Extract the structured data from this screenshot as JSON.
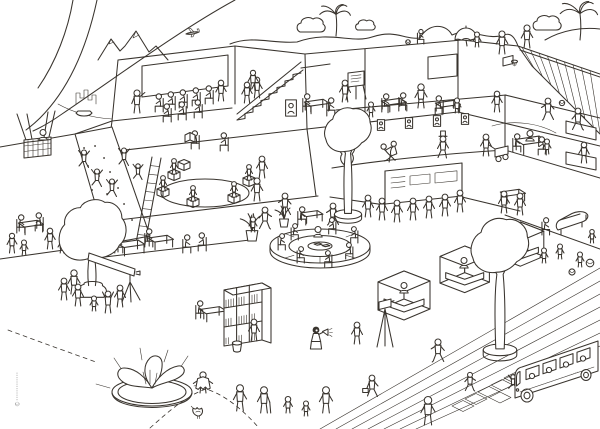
{
  "meta": {
    "copyright": "©",
    "artwork": "busy-learning-building-cutaway-illustration"
  },
  "palette": {
    "ink": "#39342e",
    "paper": "#ffffff"
  },
  "scene": {
    "items": [
      {
        "t": "mountains",
        "x": 98,
        "y": 60,
        "n": "mountains"
      },
      {
        "t": "plane",
        "x": 186,
        "y": 36,
        "n": "airplane"
      },
      {
        "t": "skyline",
        "x": 76,
        "y": 104,
        "n": "city-skyline"
      },
      {
        "t": "boat",
        "x": 84,
        "y": 115,
        "n": "rowing-boat"
      },
      {
        "t": "palm",
        "x": 336,
        "y": 36,
        "s": 0.9,
        "n": "hill-plant"
      },
      {
        "t": "bush",
        "x": 312,
        "y": 32,
        "n": "hill-bush"
      },
      {
        "t": "bush",
        "x": 366,
        "y": 30,
        "s": 0.7,
        "n": "hill-bush"
      },
      {
        "t": "psit",
        "x": 420,
        "y": 44,
        "s": 0.8,
        "n": "hill-sitter"
      },
      {
        "t": "ball",
        "x": 408,
        "y": 42,
        "s": 0.6,
        "n": "picnic-wheel"
      },
      {
        "t": "umbrella",
        "x": 466,
        "y": 40,
        "n": "roof-umbrella"
      },
      {
        "t": "pkid",
        "x": 477,
        "y": 47,
        "n": "kid-under-umbrella"
      },
      {
        "t": "pstand",
        "x": 502,
        "y": 54,
        "s": 1.05,
        "n": "ridge-walker"
      },
      {
        "t": "bush",
        "x": 548,
        "y": 30,
        "n": "hill-bush"
      },
      {
        "t": "palm",
        "x": 580,
        "y": 40,
        "s": 1.1,
        "n": "rooftop-palm"
      },
      {
        "t": "pstand",
        "x": 527,
        "y": 48,
        "s": 1.05,
        "n": "roof-person"
      },
      {
        "t": "balloonbasket",
        "x": 24,
        "y": 158,
        "n": "balloon-basket"
      },
      {
        "t": "pbust",
        "x": 43,
        "y": 140,
        "n": "balloon-passenger"
      },
      {
        "t": "ppoint",
        "x": 137,
        "y": 113,
        "s": 1.05,
        "n": "lecturer"
      },
      {
        "t": "psit",
        "x": 160,
        "y": 112,
        "f": 1,
        "n": "audience"
      },
      {
        "t": "psit",
        "x": 172,
        "y": 110,
        "f": 1,
        "n": "audience"
      },
      {
        "t": "psit",
        "x": 184,
        "y": 108,
        "f": 1,
        "n": "audience"
      },
      {
        "t": "psit",
        "x": 197,
        "y": 106,
        "f": 1,
        "n": "audience"
      },
      {
        "t": "psit",
        "x": 210,
        "y": 104,
        "f": 1,
        "n": "audience"
      },
      {
        "t": "psit",
        "x": 168,
        "y": 122,
        "f": 1,
        "n": "audience"
      },
      {
        "t": "psit",
        "x": 183,
        "y": 120,
        "f": 1,
        "n": "audience"
      },
      {
        "t": "psit",
        "x": 199,
        "y": 118,
        "f": 1,
        "n": "audience"
      },
      {
        "t": "pstand",
        "x": 221,
        "y": 101,
        "s": 0.95,
        "n": "standing-listener"
      },
      {
        "t": "pstand",
        "x": 247,
        "y": 103,
        "s": 0.95,
        "n": "stairs-person"
      },
      {
        "t": "pstand",
        "x": 257,
        "y": 98,
        "s": 0.95,
        "n": "stairs-person"
      },
      {
        "t": "pstand",
        "x": 253,
        "y": 90,
        "s": 0.9,
        "n": "stairs-person"
      },
      {
        "t": "frame",
        "x": 291,
        "y": 108,
        "s": 1.5,
        "n": "framed-picture"
      },
      {
        "t": "psit",
        "x": 196,
        "y": 149,
        "f": 1,
        "n": "armchair-reader"
      },
      {
        "t": "openbook",
        "x": 190,
        "y": 142,
        "n": "open-book"
      },
      {
        "t": "psit",
        "x": 225,
        "y": 151,
        "f": 1,
        "n": "lounger"
      },
      {
        "t": "pstand",
        "x": 262,
        "y": 178,
        "f": 1,
        "n": "phone-person"
      },
      {
        "t": "pclimb",
        "x": 84,
        "y": 168,
        "n": "climber"
      },
      {
        "t": "pclimb",
        "x": 97,
        "y": 187,
        "n": "climber"
      },
      {
        "t": "pclimb",
        "x": 112,
        "y": 197,
        "n": "climber-afro"
      },
      {
        "t": "pclimb",
        "x": 124,
        "y": 166,
        "n": "climber"
      },
      {
        "t": "ladder",
        "x": 136,
        "y": 243,
        "n": "ladder"
      },
      {
        "t": "pclimb",
        "x": 138,
        "y": 180,
        "s": 0.9,
        "n": "ladder-climber"
      },
      {
        "t": "cube",
        "x": 178,
        "y": 171,
        "n": "stool-cube"
      },
      {
        "t": "pcube",
        "x": 168,
        "y": 181,
        "n": "story-circle-kid"
      },
      {
        "t": "pcube",
        "x": 157,
        "y": 198,
        "n": "story-circle-kid"
      },
      {
        "t": "pcube",
        "x": 187,
        "y": 208,
        "n": "story-circle-kid"
      },
      {
        "t": "pcube",
        "x": 228,
        "y": 204,
        "n": "story-circle-kid"
      },
      {
        "t": "pcube",
        "x": 243,
        "y": 187,
        "n": "story-circle-kid"
      },
      {
        "t": "pstand",
        "x": 257,
        "y": 201,
        "s": 1.05,
        "n": "storyteller"
      },
      {
        "t": "easel",
        "x": 356,
        "y": 100,
        "n": "flip-chart"
      },
      {
        "t": "pstand",
        "x": 345,
        "y": 102,
        "f": 1,
        "n": "presenting-artist"
      },
      {
        "t": "desk",
        "x": 316,
        "y": 111,
        "s": 0.9,
        "n": "work-table"
      },
      {
        "t": "psit",
        "x": 306,
        "y": 112,
        "n": "pupil"
      },
      {
        "t": "psit",
        "x": 330,
        "y": 116,
        "n": "pupil"
      },
      {
        "t": "pkid",
        "x": 371,
        "y": 117,
        "n": "pupil-kid"
      },
      {
        "t": "pstand",
        "x": 421,
        "y": 108,
        "s": 1.1,
        "n": "teacher"
      },
      {
        "t": "desk",
        "x": 393,
        "y": 110,
        "s": 0.9,
        "n": "school-desk"
      },
      {
        "t": "psit",
        "x": 385,
        "y": 112,
        "n": "student"
      },
      {
        "t": "psit",
        "x": 402,
        "y": 111,
        "n": "student"
      },
      {
        "t": "desk",
        "x": 447,
        "y": 112,
        "s": 0.9,
        "n": "school-desk"
      },
      {
        "t": "psit",
        "x": 440,
        "y": 114,
        "f": 1,
        "n": "student"
      },
      {
        "t": "pkid",
        "x": 457,
        "y": 113,
        "n": "student-kid"
      },
      {
        "t": "hoop",
        "x": 503,
        "y": 66,
        "n": "basketball-hoop"
      },
      {
        "t": "pstand",
        "x": 497,
        "y": 112,
        "s": 0.95,
        "n": "basketball-player"
      },
      {
        "t": "pwalk",
        "x": 548,
        "y": 120,
        "f": 1,
        "n": "basketball-player"
      },
      {
        "t": "pwalk",
        "x": 578,
        "y": 130,
        "n": "basketball-player"
      },
      {
        "t": "ball",
        "x": 562,
        "y": 103,
        "s": 0.7,
        "n": "basketball"
      },
      {
        "t": "cypress",
        "x": 347,
        "y": 168,
        "n": "indoor-cypress"
      },
      {
        "t": "frame",
        "x": 363,
        "y": 127,
        "n": "portrait-frame"
      },
      {
        "t": "frame",
        "x": 381,
        "y": 125,
        "n": "portrait-frame"
      },
      {
        "t": "frame",
        "x": 409,
        "y": 123,
        "n": "portrait-frame"
      },
      {
        "t": "frame",
        "x": 437,
        "y": 121,
        "n": "portrait-frame"
      },
      {
        "t": "frame",
        "x": 465,
        "y": 119,
        "n": "portrait-frame"
      },
      {
        "t": "tango",
        "x": 388,
        "y": 162,
        "s": 1.1,
        "n": "tango-dancers"
      },
      {
        "t": "ptophat",
        "x": 443,
        "y": 158,
        "n": "top-hat-man"
      },
      {
        "t": "pstand",
        "x": 486,
        "y": 156,
        "f": 1,
        "n": "cart-puller"
      },
      {
        "t": "cart",
        "x": 495,
        "y": 158,
        "n": "cart"
      },
      {
        "t": "desk",
        "x": 530,
        "y": 151,
        "s": 1.15,
        "n": "dining-table"
      },
      {
        "t": "psit",
        "x": 516,
        "y": 152,
        "n": "diner"
      },
      {
        "t": "psit",
        "x": 543,
        "y": 155,
        "f": 1,
        "n": "diner"
      },
      {
        "t": "pbust",
        "x": 530,
        "y": 141,
        "n": "diner"
      },
      {
        "t": "pkid",
        "x": 547,
        "y": 154,
        "n": "diner-kid"
      },
      {
        "t": "pstand",
        "x": 584,
        "y": 163,
        "f": 1,
        "s": 0.95,
        "n": "kitchen-person"
      },
      {
        "t": "desk",
        "x": 30,
        "y": 232,
        "s": 0.9,
        "n": "cafe-table"
      },
      {
        "t": "psit",
        "x": 20,
        "y": 233,
        "n": "cafe-guest"
      },
      {
        "t": "psit",
        "x": 40,
        "y": 231,
        "f": 1,
        "n": "cafe-guest"
      },
      {
        "t": "pstand",
        "x": 12,
        "y": 253,
        "s": 0.9,
        "n": "bystander"
      },
      {
        "t": "pkid",
        "x": 24,
        "y": 255,
        "n": "kid"
      },
      {
        "t": "pstand",
        "x": 50,
        "y": 249,
        "s": 0.95,
        "n": "bystander"
      },
      {
        "t": "pkid",
        "x": 62,
        "y": 253,
        "n": "kid"
      },
      {
        "t": "pstand",
        "x": 96,
        "y": 232,
        "f": 1,
        "n": "seed-sower"
      },
      {
        "t": "seeds",
        "x": 98,
        "y": 231,
        "n": "seeds"
      },
      {
        "t": "pstand",
        "x": 113,
        "y": 228,
        "n": "gardener"
      },
      {
        "t": "desk",
        "x": 130,
        "y": 253,
        "n": "study-desk"
      },
      {
        "t": "psit",
        "x": 118,
        "y": 253,
        "n": "laptop-user"
      },
      {
        "t": "desk",
        "x": 160,
        "y": 247,
        "s": 0.9,
        "n": "study-desk"
      },
      {
        "t": "psit",
        "x": 148,
        "y": 247,
        "n": "laptop-user"
      },
      {
        "t": "psit",
        "x": 186,
        "y": 253,
        "n": "lounge-guest"
      },
      {
        "t": "psit",
        "x": 203,
        "y": 251,
        "f": 1,
        "n": "lounge-guest"
      },
      {
        "t": "plantpot",
        "x": 252,
        "y": 241,
        "s": 1.3,
        "n": "potted-plant"
      },
      {
        "t": "plantpot",
        "x": 284,
        "y": 227,
        "n": "potted-plant"
      },
      {
        "t": "psit",
        "x": 301,
        "y": 225,
        "n": "corner-reader"
      },
      {
        "t": "desk",
        "x": 311,
        "y": 221,
        "s": 0.8,
        "n": "side-table"
      },
      {
        "t": "pwalk",
        "x": 265,
        "y": 229,
        "n": "plaza-walker"
      },
      {
        "t": "pkid",
        "x": 253,
        "y": 232,
        "n": "plaza-kid"
      },
      {
        "t": "pwalk",
        "x": 285,
        "y": 215,
        "f": 1,
        "n": "plaza-walker"
      },
      {
        "t": "pwalk",
        "x": 333,
        "y": 225,
        "f": 1,
        "n": "plaza-walker"
      },
      {
        "t": "pstand",
        "x": 368,
        "y": 217,
        "f": 1,
        "n": "tour-visitor"
      },
      {
        "t": "pstand",
        "x": 382,
        "y": 220,
        "f": 1,
        "n": "tour-visitor"
      },
      {
        "t": "pstand",
        "x": 397,
        "y": 222,
        "n": "tour-visitor"
      },
      {
        "t": "pstand",
        "x": 413,
        "y": 220,
        "n": "tour-visitor"
      },
      {
        "t": "pstand",
        "x": 429,
        "y": 218,
        "f": 1,
        "n": "tour-visitor"
      },
      {
        "t": "pstand",
        "x": 445,
        "y": 216,
        "n": "tour-visitor"
      },
      {
        "t": "pstand",
        "x": 460,
        "y": 212,
        "n": "tour-guide"
      },
      {
        "t": "sofa",
        "x": 320,
        "y": 253,
        "n": "round-sofa"
      },
      {
        "t": "psit",
        "x": 294,
        "y": 240,
        "s": 0.9,
        "n": "sofa-reader"
      },
      {
        "t": "psit",
        "x": 281,
        "y": 250,
        "s": 0.9,
        "n": "sofa-reader"
      },
      {
        "t": "psit",
        "x": 300,
        "y": 263,
        "s": 0.9,
        "n": "sofa-reader"
      },
      {
        "t": "psit",
        "x": 329,
        "y": 267,
        "f": 1,
        "s": 0.9,
        "n": "sofa-reader"
      },
      {
        "t": "psit",
        "x": 350,
        "y": 259,
        "f": 1,
        "s": 0.9,
        "n": "sofa-reader"
      },
      {
        "t": "psit",
        "x": 355,
        "y": 243,
        "f": 1,
        "s": 0.9,
        "n": "sofa-reader"
      },
      {
        "t": "psit",
        "x": 333,
        "y": 234,
        "f": 1,
        "s": 0.9,
        "n": "sofa-reader"
      },
      {
        "t": "pbust",
        "x": 318,
        "y": 237,
        "n": "sofa-reader"
      },
      {
        "t": "stall",
        "x": 378,
        "y": 312,
        "n": "market-stall"
      },
      {
        "t": "pbust",
        "x": 404,
        "y": 293,
        "n": "stall-vendor"
      },
      {
        "t": "stall",
        "x": 440,
        "y": 285,
        "s": 0.95,
        "n": "market-stall"
      },
      {
        "t": "pbust",
        "x": 464,
        "y": 268,
        "n": "stall-vendor"
      },
      {
        "t": "stall",
        "x": 497,
        "y": 259,
        "s": 0.9,
        "n": "market-stall"
      },
      {
        "t": "pbust",
        "x": 519,
        "y": 243,
        "n": "stall-vendor"
      },
      {
        "t": "desk",
        "x": 512,
        "y": 201,
        "s": 0.9,
        "n": "exhibit-table"
      },
      {
        "t": "pstand",
        "x": 504,
        "y": 213,
        "n": "exhibit-visitor"
      },
      {
        "t": "pstand",
        "x": 520,
        "y": 215,
        "f": 1,
        "n": "exhibit-visitor"
      },
      {
        "t": "piano",
        "x": 558,
        "y": 230,
        "n": "piano"
      },
      {
        "t": "psit",
        "x": 545,
        "y": 235,
        "s": 0.95,
        "n": "piano-player"
      },
      {
        "t": "pkid",
        "x": 544,
        "y": 263,
        "n": "playing-kid"
      },
      {
        "t": "pkid",
        "x": 560,
        "y": 259,
        "f": 1,
        "n": "playing-kid"
      },
      {
        "t": "pkid",
        "x": 580,
        "y": 267,
        "n": "playing-kid"
      },
      {
        "t": "ball",
        "x": 590,
        "y": 263,
        "n": "play-ball"
      },
      {
        "t": "ball",
        "x": 572,
        "y": 272,
        "s": 0.8,
        "n": "play-ball"
      },
      {
        "t": "pkid",
        "x": 592,
        "y": 243,
        "s": 0.9,
        "n": "playing-kid"
      },
      {
        "t": "tree2",
        "x": 348,
        "y": 216,
        "s": 0.85,
        "n": "atrium-tree"
      },
      {
        "t": "tree1",
        "x": 92,
        "y": 296,
        "s": 1.3,
        "n": "plaza-tree-left"
      },
      {
        "t": "pstand",
        "x": 74,
        "y": 294,
        "s": 1.1,
        "n": "woman-by-tree"
      },
      {
        "t": "telescope",
        "x": 132,
        "y": 290,
        "n": "telescope"
      },
      {
        "t": "pstand",
        "x": 64,
        "y": 300,
        "f": 1,
        "n": "stargazer"
      },
      {
        "t": "pstand",
        "x": 78,
        "y": 306,
        "f": 1,
        "n": "stargazer"
      },
      {
        "t": "parms",
        "x": 108,
        "y": 313,
        "n": "cheering-person"
      },
      {
        "t": "pkid",
        "x": 94,
        "y": 311,
        "n": "stargazer-kid"
      },
      {
        "t": "pstand",
        "x": 120,
        "y": 307,
        "f": 1,
        "n": "stargazer"
      },
      {
        "t": "desk",
        "x": 212,
        "y": 319,
        "s": 0.95,
        "n": "reading-desk"
      },
      {
        "t": "psit",
        "x": 199,
        "y": 319,
        "n": "desk-reader"
      },
      {
        "t": "shelf",
        "x": 224,
        "y": 346,
        "n": "bookshelf"
      },
      {
        "t": "pstand",
        "x": 254,
        "y": 341,
        "f": 1,
        "n": "browsing-person"
      },
      {
        "t": "bucket",
        "x": 237,
        "y": 351,
        "n": "bucket"
      },
      {
        "t": "pmega",
        "x": 316,
        "y": 349,
        "n": "megaphone-woman"
      },
      {
        "t": "pstand",
        "x": 357,
        "y": 344,
        "f": 1,
        "n": "listener"
      },
      {
        "t": "camera",
        "x": 380,
        "y": 347,
        "n": "camera-tripod"
      },
      {
        "t": "pbrief",
        "x": 372,
        "y": 397,
        "f": 1,
        "n": "briefcase-man"
      },
      {
        "t": "pwalk",
        "x": 438,
        "y": 362,
        "f": 1,
        "s": 1.05,
        "n": "walking-woman"
      },
      {
        "t": "pwalk",
        "x": 470,
        "y": 391,
        "s": 0.85,
        "n": "running-kid"
      },
      {
        "t": "pstand",
        "x": 428,
        "y": 425,
        "s": 1.3,
        "n": "overcoat-man"
      },
      {
        "t": "hopscotch",
        "x": 452,
        "y": 406,
        "n": "hopscotch"
      },
      {
        "t": "pclimb",
        "x": 513,
        "y": 390,
        "s": 0.85,
        "n": "hopping-kid"
      },
      {
        "t": "tree2",
        "x": 500,
        "y": 352,
        "s": 1.05,
        "n": "plaza-tree-right"
      },
      {
        "t": "planter",
        "x": 152,
        "y": 392,
        "n": "leaf-planter"
      },
      {
        "t": "leafkid",
        "x": 203,
        "y": 393,
        "s": 1.2,
        "n": "costume-kid"
      },
      {
        "t": "bird",
        "x": 199,
        "y": 416,
        "s": 1.3,
        "n": "bird"
      },
      {
        "t": "pstand",
        "x": 240,
        "y": 411,
        "s": 1.2,
        "n": "grandfather"
      },
      {
        "t": "pcane",
        "x": 264,
        "y": 413,
        "s": 1.2,
        "n": "grandmother"
      },
      {
        "t": "pkid",
        "x": 288,
        "y": 413,
        "s": 1.1,
        "n": "child"
      },
      {
        "t": "pkid",
        "x": 306,
        "y": 416,
        "n": "toddler"
      },
      {
        "t": "pstand",
        "x": 326,
        "y": 413,
        "s": 1.2,
        "n": "parent"
      },
      {
        "t": "bus",
        "x": 514,
        "y": 398,
        "n": "bus"
      }
    ]
  }
}
